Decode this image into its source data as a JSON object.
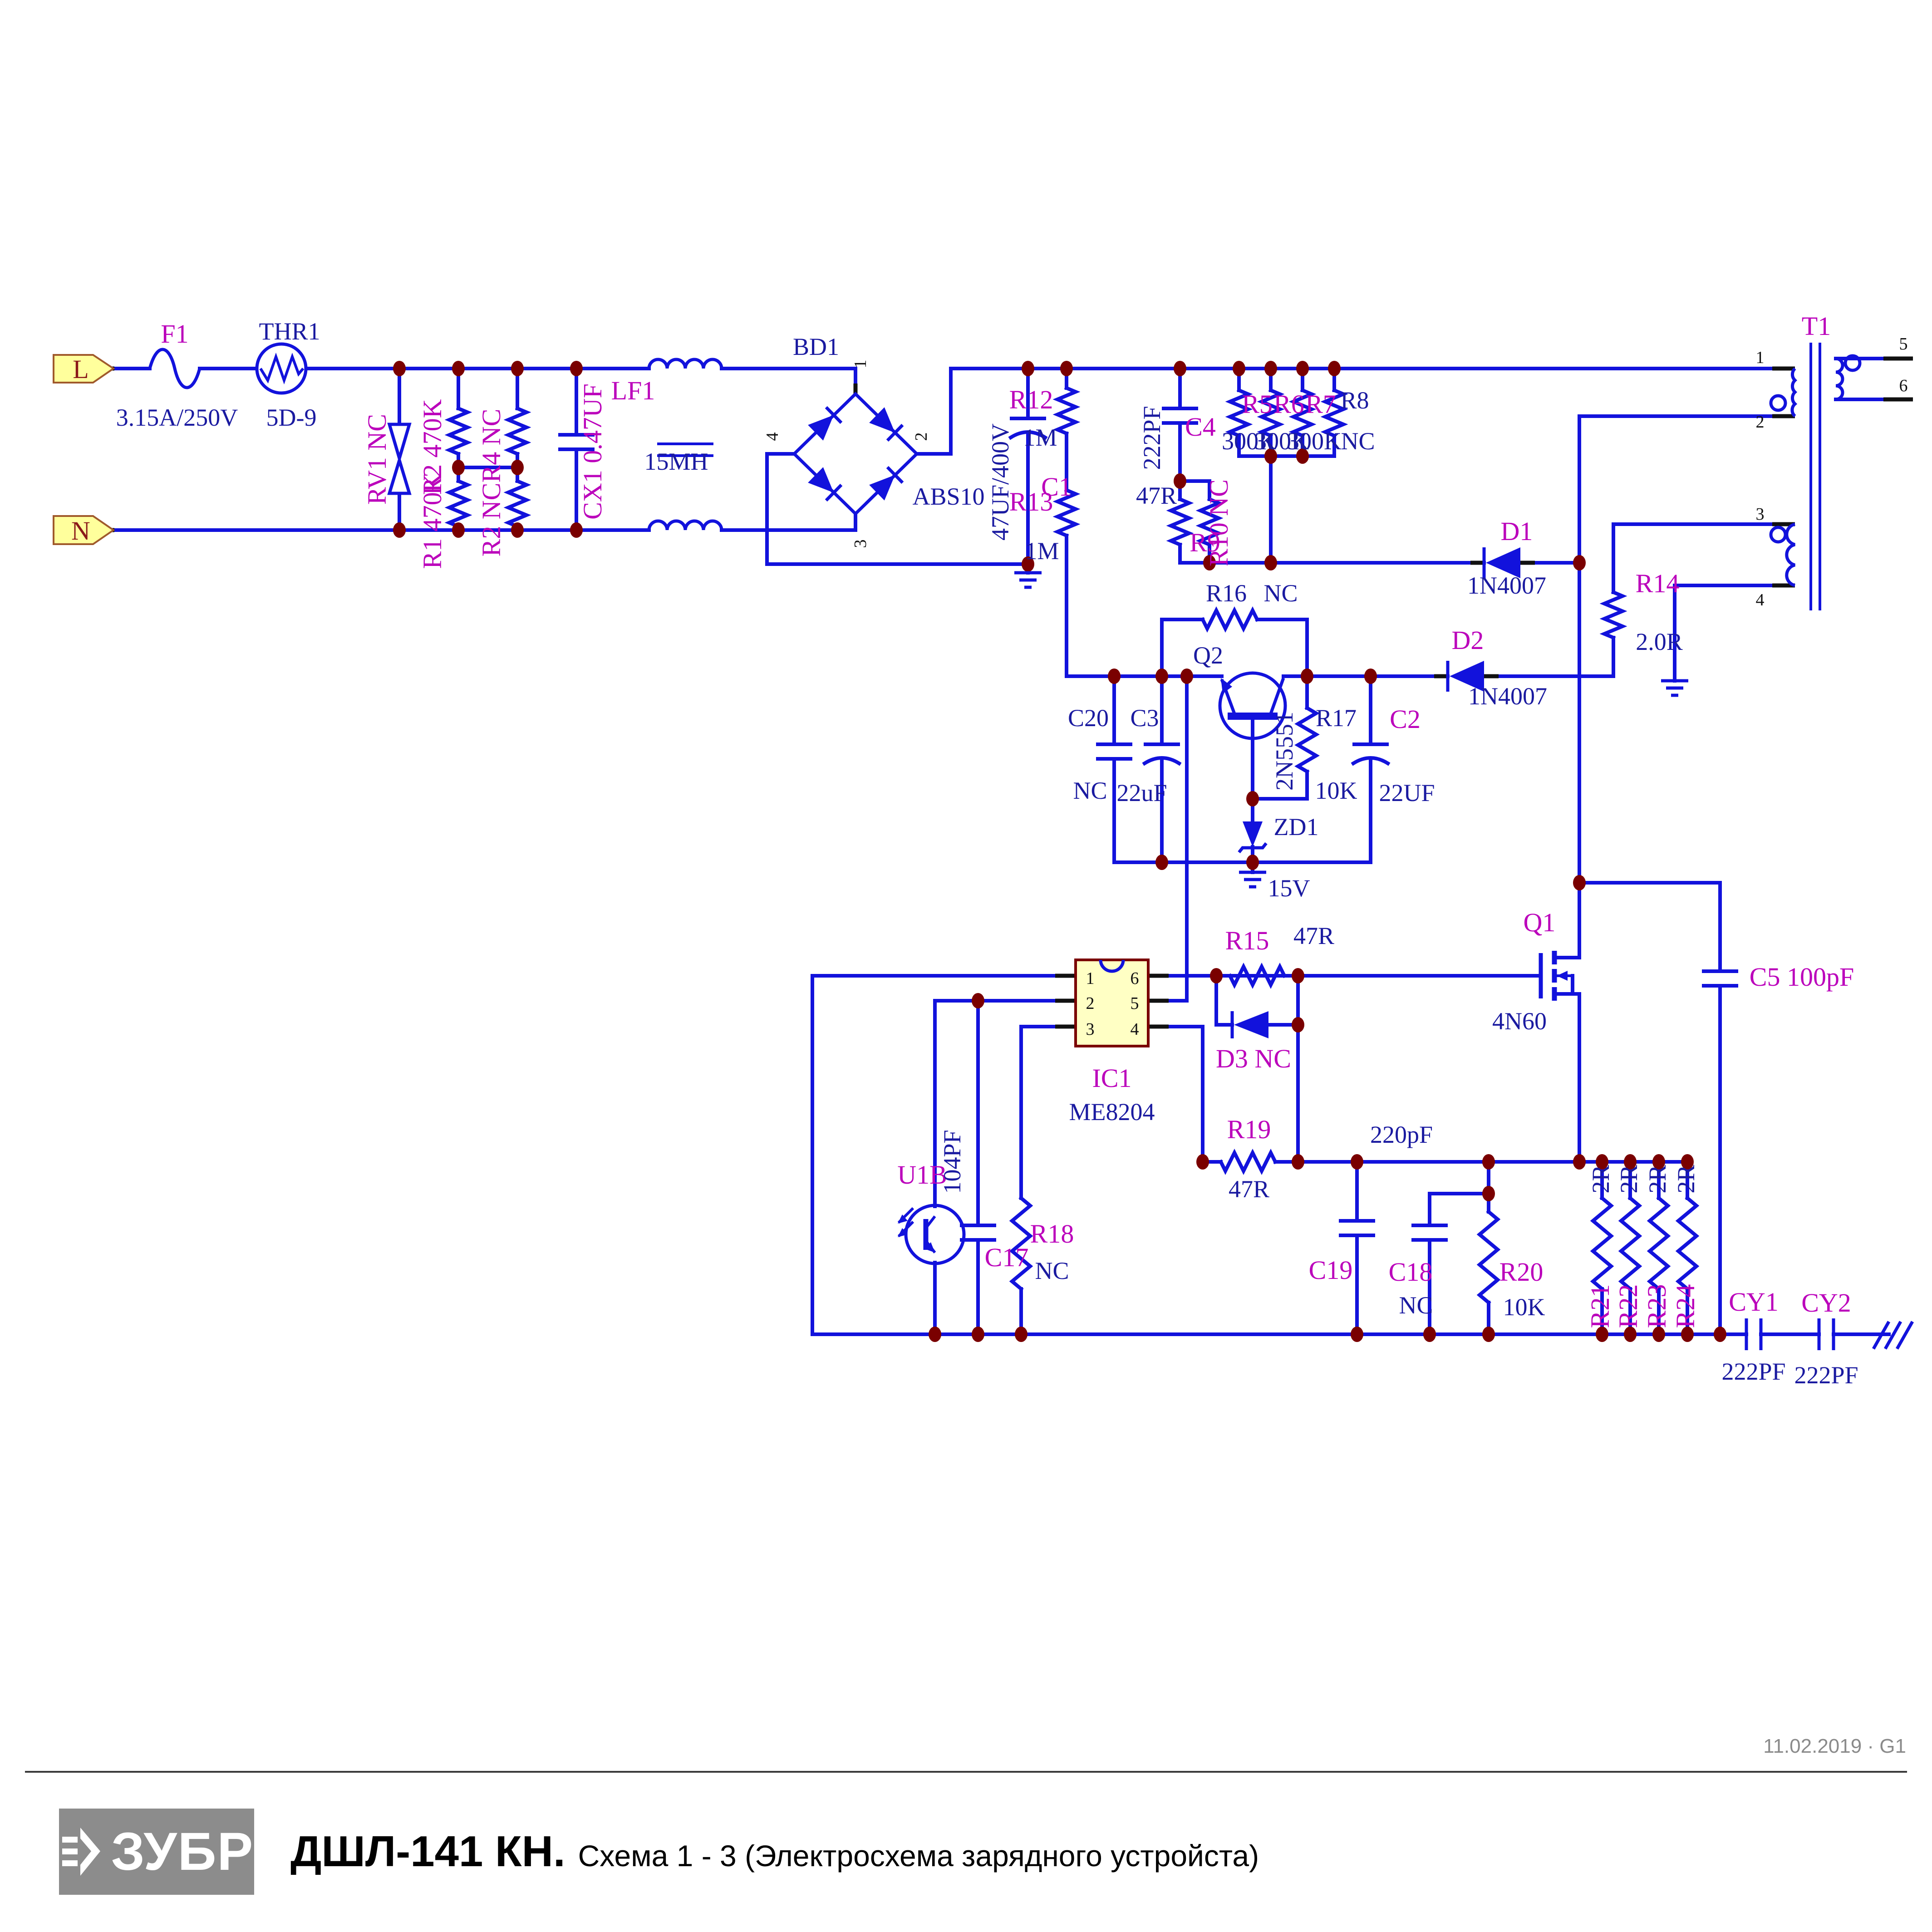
{
  "labels": {
    "term_l": "L",
    "term_n": "N",
    "f1": "F1",
    "f1_value": "3.15A/250V",
    "thr1": "THR1",
    "thr1_value": "5D-9",
    "rv1": "RV1 NC",
    "r2a": "R2 470K",
    "r1": "R1 470K",
    "r4": "R4 NC",
    "r2b": "R2 NC",
    "cx1": "CX1 0.47UF",
    "lf1": "LF1",
    "lf1_value": "15MH",
    "bd1": "BD1",
    "bd1_value": "ABS10",
    "bd1_pin1": "1",
    "bd1_pin2": "2",
    "bd1_pin3": "3",
    "bd1_pin4": "4",
    "c1": "C1",
    "c1_value": "47UF/400V",
    "r12": "R12",
    "r12_value": "1M",
    "r13": "R13",
    "r13_value": "1M",
    "c4": "C4",
    "c4_value": "222PF",
    "r5": "R5",
    "r5_value": "300K",
    "r6": "R6",
    "r6_value": "300K",
    "r7": "R7",
    "r7_value": "300K",
    "r8": "R8",
    "r8_value": "NC",
    "r9": "R9",
    "r9_value": "47R",
    "r10": "R10 NC",
    "d1": "D1",
    "d1_value": "1N4007",
    "r14": "R14",
    "r14_value": "2.0R",
    "t1": "T1",
    "t1_pin1": "1",
    "t1_pin2": "2",
    "t1_pin3": "3",
    "t1_pin4": "4",
    "t1_pin5": "5",
    "t1_pin6": "6",
    "r16": "R16",
    "r16_value": "NC",
    "q2": "Q2",
    "q2_value": "2N5551",
    "c20": "C20",
    "c20_value": "NC",
    "c3": "C3",
    "c3_value": "22uF",
    "r17": "R17",
    "r17_value": "10K",
    "c2": "C2",
    "c2_value": "22UF",
    "zd1": "ZD1",
    "zd1_value": "15V",
    "d2": "D2",
    "d2_value": "1N4007",
    "ic1": "IC1",
    "ic1_value": "ME8204",
    "ic1_pin1": "1",
    "ic1_pin2": "2",
    "ic1_pin3": "3",
    "ic1_pin4": "4",
    "ic1_pin5": "5",
    "ic1_pin6": "6",
    "r15": "R15",
    "r15_value": "47R",
    "d3": "D3 NC",
    "q1": "Q1",
    "q1_value": "4N60",
    "c5": "C5 100pF",
    "r19": "R19",
    "r19_value": "47R",
    "u1b": "U1B",
    "c17": "C17",
    "c17_value": "104PF",
    "r18": "R18",
    "r18_value": "NC",
    "c19": "C19",
    "c19_value": "220pF",
    "c18": "C18",
    "c18_value": "NC",
    "r20": "R20",
    "r20_value": "10K",
    "r21": "R21",
    "r21_value": "2R",
    "r22": "R22",
    "r22_value": "2R",
    "r23": "R23",
    "r23_value": "2R",
    "r24": "R24",
    "r24_value": "2R",
    "cy1": "CY1",
    "cy1_value": "222PF",
    "cy2": "CY2",
    "cy2_value": "222PF"
  },
  "footer": {
    "date": "11.02.2019 · G1",
    "logo": "ЗУБР",
    "model": "ДШЛ-141 КН.",
    "subtitle": "Схема 1 - 3 (Электросхема зарядного устройста)"
  },
  "colors": {
    "wire_blue": "#1212DC",
    "designator_magenta": "#BB00BB",
    "text_navy": "#1A1AA0",
    "junction_maroon": "#7A0000",
    "terminal_yellow": "#FFFF9C",
    "ic_yellow": "#FFFFC4",
    "logo_gray": "#8C8C8C"
  }
}
